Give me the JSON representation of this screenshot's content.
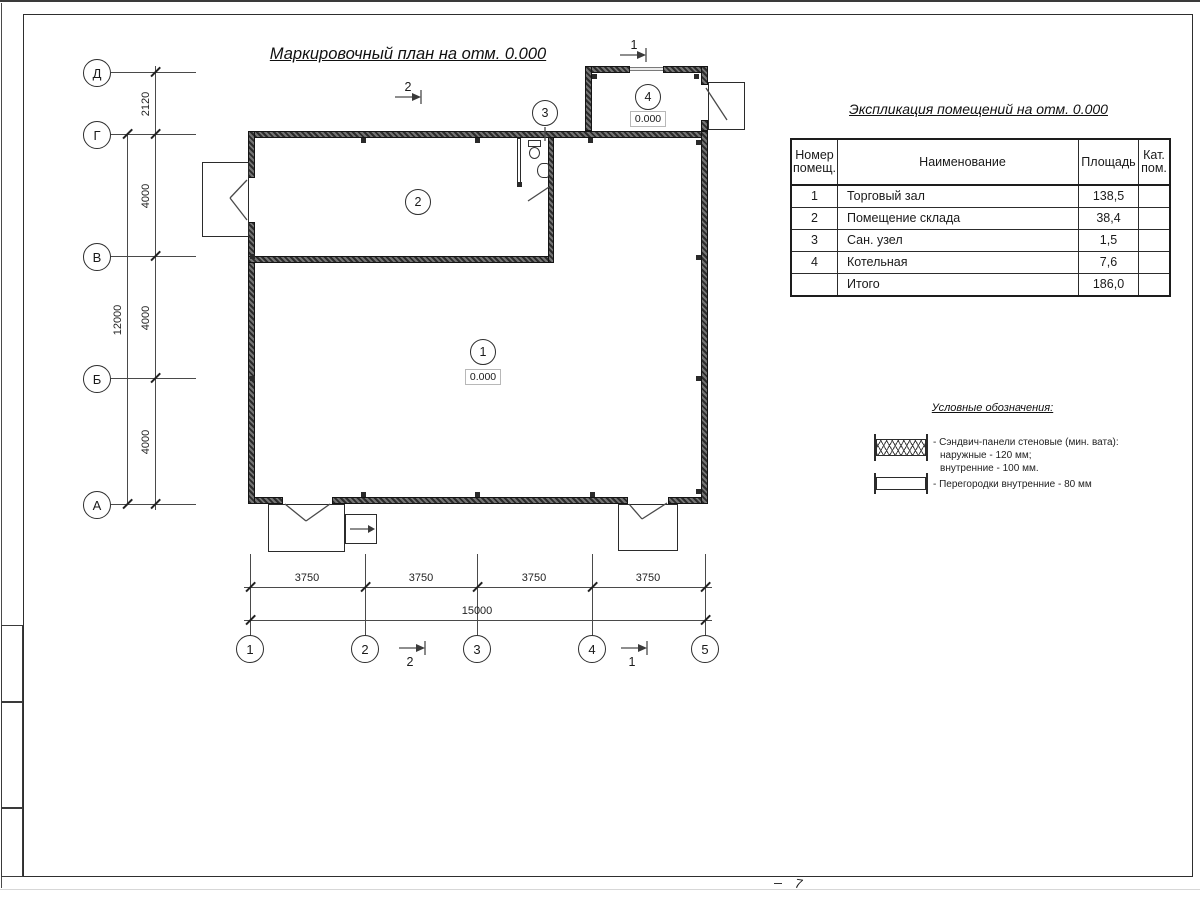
{
  "titles": {
    "plan_title": "Маркировочный план на отм. 0.000",
    "table_title": "Экспликация помещений на отм. 0.000",
    "legend_title": "Условные обозначения:"
  },
  "axes": {
    "left": [
      "Д",
      "Г",
      "В",
      "Б",
      "А"
    ],
    "bottom": [
      "1",
      "2",
      "3",
      "4",
      "5"
    ]
  },
  "dimensions": {
    "left_spans": [
      "2120",
      "4000",
      "4000",
      "4000"
    ],
    "left_total": "12000",
    "bottom_spans": [
      "3750",
      "3750",
      "3750",
      "3750"
    ],
    "bottom_total": "15000"
  },
  "rooms": [
    {
      "number": "1",
      "elevation": "0.000"
    },
    {
      "number": "2"
    },
    {
      "number": "3"
    },
    {
      "number": "4",
      "elevation": "0.000"
    }
  ],
  "section_markers": {
    "top_mid": "2",
    "top_right": "1",
    "bottom_left": "2",
    "bottom_right": "1"
  },
  "table": {
    "headers": [
      "Номер помещ.",
      "Наименование",
      "Площадь",
      "Кат. пом."
    ],
    "rows": [
      {
        "number": "1",
        "name": "Торговый зал",
        "area": "138,5",
        "cat": ""
      },
      {
        "number": "2",
        "name": "Помещение склада",
        "area": "38,4",
        "cat": ""
      },
      {
        "number": "3",
        "name": "Сан. узел",
        "area": "1,5",
        "cat": ""
      },
      {
        "number": "4",
        "name": "Котельная",
        "area": "7,6",
        "cat": ""
      },
      {
        "number": "",
        "name": "Итого",
        "area": "186,0",
        "cat": ""
      }
    ]
  },
  "legend": {
    "items": [
      {
        "label_lines": [
          "- Сэндвич-панели стеновые (мин. вата):",
          "наружные - 120 мм;",
          "внутренние - 100 мм."
        ]
      },
      {
        "label_lines": [
          "- Перегородки внутренние - 80 мм"
        ]
      }
    ]
  },
  "sheet": {
    "page_mark": "7"
  }
}
